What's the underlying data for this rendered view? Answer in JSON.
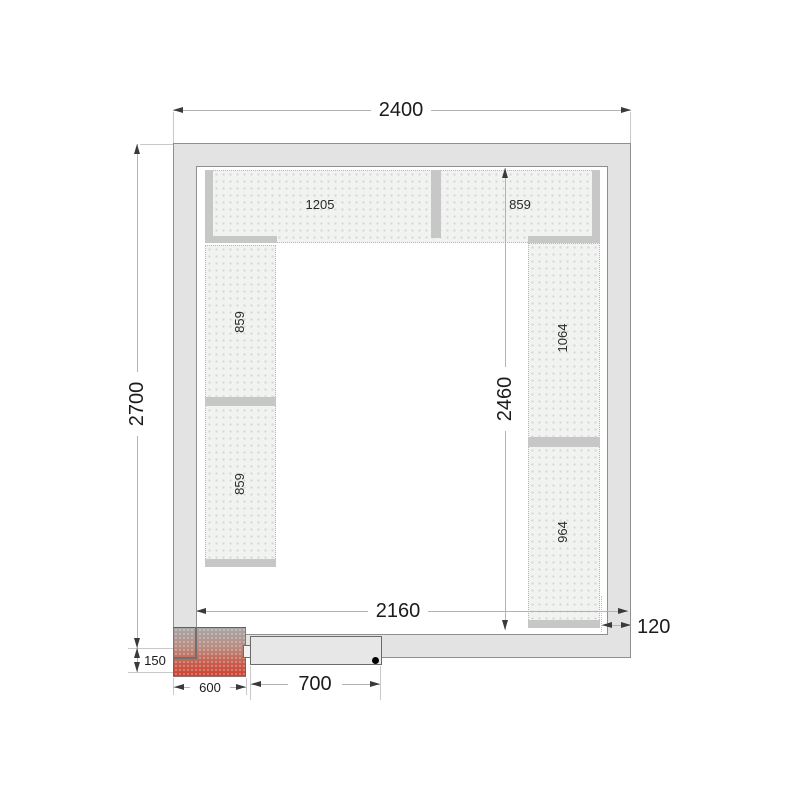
{
  "labels": {
    "outer_width": "2400",
    "outer_height": "2700",
    "inner_width": "2160",
    "inner_height": "2460",
    "wall_thickness": "120",
    "unit_height": "150",
    "unit_width": "600",
    "door_width": "700"
  },
  "shelf_labels": {
    "top_left": "1205",
    "top_right": "859",
    "left_upper": "859",
    "left_lower": "859",
    "right_upper": "1064",
    "right_lower": "964"
  },
  "colors": {
    "wall_fill": "#e3e3e3",
    "wall_stroke": "#8f8f8f",
    "shelf_fill": "#f1f3f0",
    "shelf_bar": "#c7c7c7",
    "dim_line": "#b3b3b3",
    "arrow": "#3a3a3a",
    "unit_red": "#cd4334",
    "text": "#1b1b1b"
  }
}
